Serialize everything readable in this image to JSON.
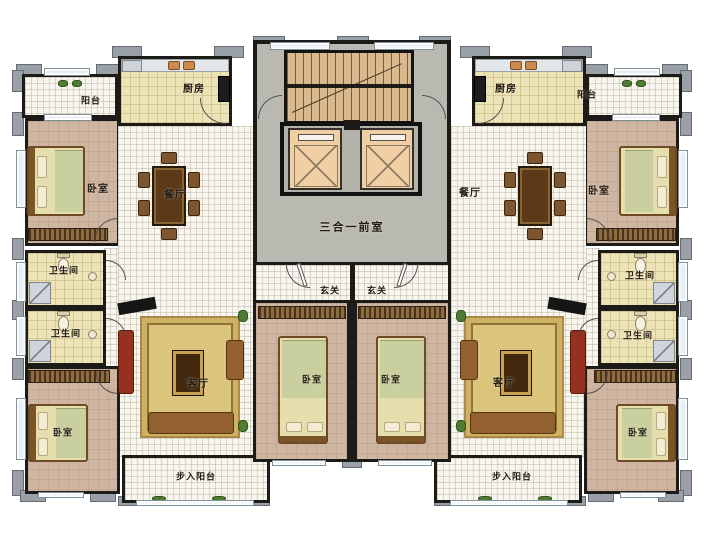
{
  "plan_type": "residential-floor-plan",
  "labels": {
    "core": {
      "lobby": "三合一前室"
    },
    "left": {
      "balcony_top": "阳台",
      "kitchen": "厨房",
      "bedroom_top": "卧室",
      "dining": "餐厅",
      "bath_upper": "卫生间",
      "bath_lower": "卫生间",
      "bedroom_bottom": "卧室",
      "living": "客厅",
      "entry": "玄关",
      "bedroom_center": "卧室",
      "walkin_balcony": "步入阳台"
    },
    "right": {
      "balcony_top": "阳台",
      "kitchen": "厨房",
      "bedroom_top": "卧室",
      "dining": "餐厅",
      "bath_upper": "卫生间",
      "bath_lower": "卫生间",
      "bedroom_bottom": "卧室",
      "living": "客厅",
      "entry": "玄关",
      "bedroom_center": "卧室",
      "walkin_balcony": "步入阳台"
    }
  },
  "colors": {
    "wall": "#1c1b18",
    "pier": "#9aa0a8",
    "tile_floor": "#f8f6ef",
    "kitchen_bath_floor": "#ece3b6",
    "bedroom_floor": "#cfb6a2",
    "core_floor": "#b9b9b1",
    "stairs": "#d9ba8e",
    "elevator_car": "#f1cfa5",
    "rug": "#dbc47c",
    "bed": "#e4dfad",
    "window": "#e8eef2",
    "plant": "#4e7c30"
  }
}
